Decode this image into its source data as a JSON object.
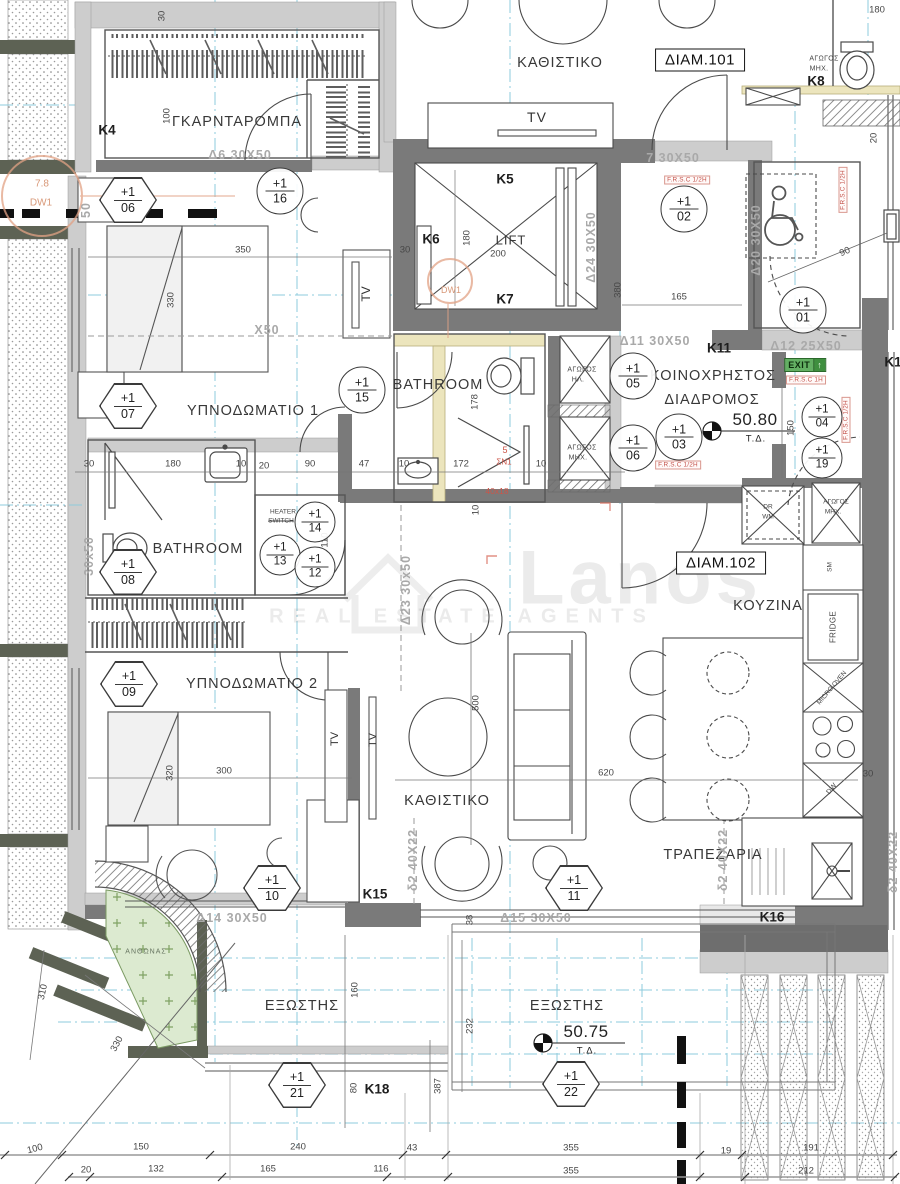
{
  "rooms": {
    "wardrobe": "ΓΚΑΡΝΤΑΡΟΜΠΑ",
    "living1": "ΚΑΘΙΣΤΙΚΟ",
    "lift": "LIFT",
    "bedroom1": "ΥΠΝΟΔΩΜΑΤΙΟ 1",
    "bathroom1": "BATHROOM",
    "bathroom2": "BATHROOM",
    "corridor_l1": "ΚΟΙΝΟΧΡΗΣΤΟΣ",
    "corridor_l2": "ΔΙΑΔΡΟΜΟΣ",
    "kitchen": "ΚΟΥΖΙΝΑ",
    "bedroom2": "ΥΠΝΟΔΩΜΑΤΙΟ 2",
    "living2": "ΚΑΘΙΣΤΙΚΟ",
    "dining": "ΤΡΑΠΕΖΑΡΙΑ",
    "balcony1": "ΕΞΩΣΤΗΣ",
    "balcony2": "ΕΞΩΣΤΗΣ",
    "flowerbed": "ΑΝΘΩΝΑΣ"
  },
  "apartments": {
    "a101": "ΔΙΑΜ.101",
    "a102": "ΔΙΑΜ.102"
  },
  "levels": {
    "corridor_value": "50.80",
    "balcony_value": "50.75",
    "datum": "Τ.Δ."
  },
  "columns": {
    "k4": "K4",
    "k5": "K5",
    "k6": "K6",
    "k7": "K7",
    "k8": "K8",
    "k11": "K11",
    "k15": "K15",
    "k16": "K16",
    "k18": "K18",
    "k1": "K1"
  },
  "beams": {
    "d6": "Δ6 30X50",
    "d7": "7 30X50",
    "d24": "Δ24 30X50",
    "d11": "Δ11 30X50",
    "d12": "Δ12 25X50",
    "d23": "Δ23 30x50",
    "d15": "Δ15 30X50",
    "d14": "Δ14 30X50",
    "d20": "Δ20 30X50",
    "s2a": "δ2 40X22",
    "s2b": "δ2 40X22",
    "s2c": "δ2 40X22",
    "x50": "X50",
    "w3050": "30x50",
    "p50": "50"
  },
  "fire": {
    "half": "F.R.S.C 1/2H",
    "one": "F.R.S.C 1H"
  },
  "exit": {
    "label": "EXIT",
    "arrow": "↑"
  },
  "tv": "TV",
  "appliances": {
    "dr": "DR",
    "wm": "WM",
    "sm": "SM",
    "fridge": "FRIDGE",
    "micro": "MICRO OVEN",
    "dw": "DW"
  },
  "ducts": {
    "agogos": "ΑΓΩΓΟΣ",
    "mech": "ΜΗΧ.",
    "elec": "ΗΛ."
  },
  "heater": {
    "l1": "HEATER",
    "l2": "SWITCH"
  },
  "stamps": {
    "dw1": "DW1",
    "val": "7.8",
    "five": "5",
    "sn": "ΣΝ1",
    "size": "40x18"
  },
  "watermark": {
    "brand": "Lanos",
    "tagline": "REAL ESTATE AGENTS"
  },
  "markers": {
    "c16": [
      "+1",
      "16"
    ],
    "c02": [
      "+1",
      "02"
    ],
    "c15": [
      "+1",
      "15"
    ],
    "c05": [
      "+1",
      "05"
    ],
    "c06": [
      "+1",
      "06"
    ],
    "c03": [
      "+1",
      "03"
    ],
    "c04": [
      "+1",
      "04"
    ],
    "c19": [
      "+1",
      "19"
    ],
    "c01": [
      "+1",
      "01"
    ],
    "c14": [
      "+1",
      "14"
    ],
    "c13": [
      "+1",
      "13"
    ],
    "c12": [
      "+1",
      "12"
    ],
    "h06": [
      "+1",
      "06"
    ],
    "h07": [
      "+1",
      "07"
    ],
    "h08": [
      "+1",
      "08"
    ],
    "h09": [
      "+1",
      "09"
    ],
    "h10": [
      "+1",
      "10"
    ],
    "h11": [
      "+1",
      "11"
    ],
    "h21": [
      "+1",
      "21"
    ],
    "h22": [
      "+1",
      "22"
    ]
  },
  "dims": {
    "d1": "30",
    "d2": "100",
    "d3": "350",
    "d4": "330",
    "d5": "30",
    "d6": "180",
    "d7": "200",
    "d8": "165",
    "d9": "380",
    "d10": "180",
    "d11": "20",
    "d12": "90",
    "d13": "150",
    "d15": "178",
    "d16": "10",
    "d17": "172",
    "d18": "10",
    "d19": "30",
    "d20": "180",
    "d21": "10",
    "d22": "20",
    "d23": "90",
    "d24": "47",
    "d25": "110",
    "d27": "10",
    "d28": "300",
    "d29": "320",
    "d30": "500",
    "d31": "620",
    "d32": "38",
    "d33": "160",
    "d34": "80",
    "d35": "330",
    "d36": "310",
    "d37": "232",
    "d38": "387",
    "d39": "43",
    "d40": "355",
    "d41": "19",
    "d42": "191",
    "d43": "100",
    "d44": "150",
    "d45": "240",
    "d46": "20",
    "d47": "132",
    "d48": "165",
    "d49": "116",
    "d50": "355",
    "d51": "212",
    "d52": "30"
  }
}
